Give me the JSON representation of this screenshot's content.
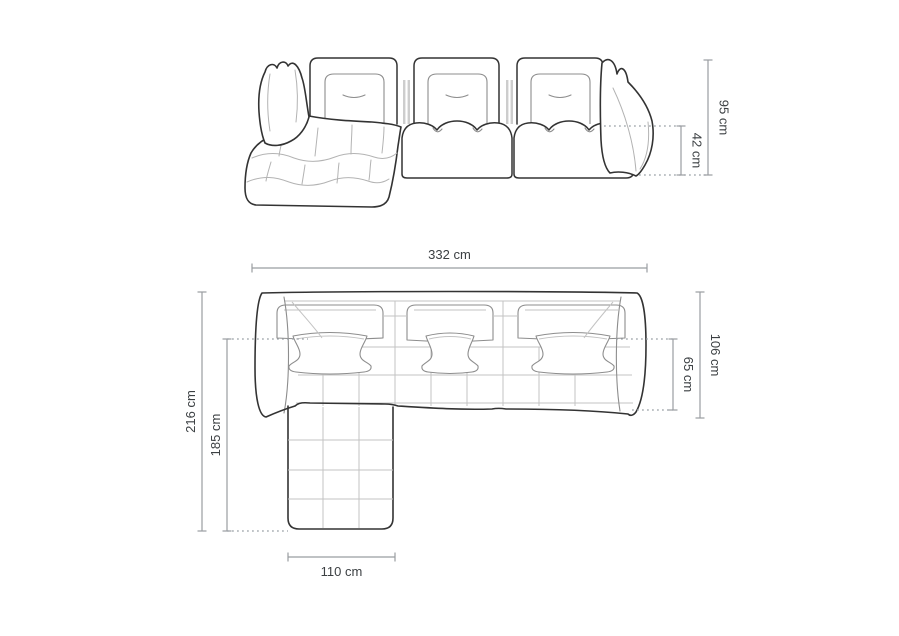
{
  "unit": "cm",
  "colors": {
    "background": "#ffffff",
    "outline_dark": "#333333",
    "outline_medium": "#8d8d8d",
    "outline_light": "#c3c3c3",
    "dimension_line": "#999da1",
    "label_text": "#3c4043"
  },
  "front_view": {
    "dims": {
      "total_height": {
        "value": 95,
        "unit": "cm",
        "label": "95 cm"
      },
      "seat_height": {
        "value": 42,
        "unit": "cm",
        "label": "42 cm"
      }
    }
  },
  "plan_view": {
    "dims": {
      "total_width": {
        "value": 332,
        "unit": "cm",
        "label": "332 cm"
      },
      "total_depth": {
        "value": 106,
        "unit": "cm",
        "label": "106 cm"
      },
      "seat_depth": {
        "value": 65,
        "unit": "cm",
        "label": "65 cm"
      },
      "overall_depth": {
        "value": 216,
        "unit": "cm",
        "label": "216 cm"
      },
      "chaise_depth": {
        "value": 185,
        "unit": "cm",
        "label": "185 cm"
      },
      "chaise_width": {
        "value": 110,
        "unit": "cm",
        "label": "110 cm"
      }
    }
  }
}
